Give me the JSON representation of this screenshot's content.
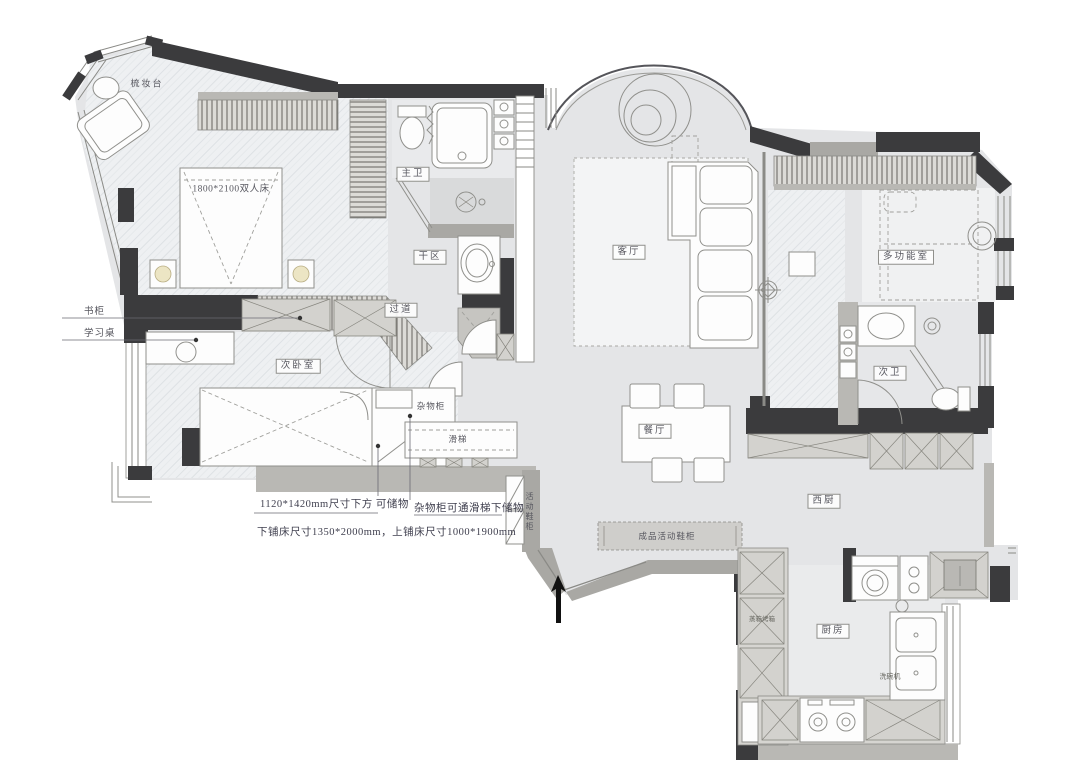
{
  "plan_title": "residential floor plan",
  "rooms": {
    "dressing_table": "梳妆台",
    "master_bed_size": "1800*2100双人床",
    "master_bath": "主卫",
    "dry_area": "干区",
    "hallway": "过道",
    "living_room": "客厅",
    "multi_function_room": "多功能室",
    "second_bath": "次卫",
    "second_bedroom": "次卧室",
    "dining_room": "餐厅",
    "west_kitchen": "西厨",
    "kitchen": "厨房"
  },
  "furniture_labels": {
    "storage_cabinet": "杂物柜",
    "slide": "滑梯",
    "mobile_shoe_cabinet": "活动鞋柜",
    "entry_shoe_cabinet": "成品活动鞋柜",
    "steam_oven": "蒸箱烤箱",
    "dishwasher": "洗碗机",
    "bookcase": "书柜",
    "study_desk": "学习桌"
  },
  "annotations": {
    "under_bed_storage": "1120*1420mm尺寸下方 可储物",
    "cabinet_slide_storage": "杂物柜可通滑梯下储物",
    "bunk_bed_sizes": "下铺床尺寸1350*2000mm，上铺床尺寸1000*1900mm"
  },
  "symbols": {
    "entry_arrow": "entrance direction arrow"
  },
  "colors": {
    "wall_dark": "#3b3b3d",
    "wall_gray": "#a9a8a4",
    "floor_gray": "#e4e5e7",
    "lamp_cream": "#ece5c4"
  }
}
